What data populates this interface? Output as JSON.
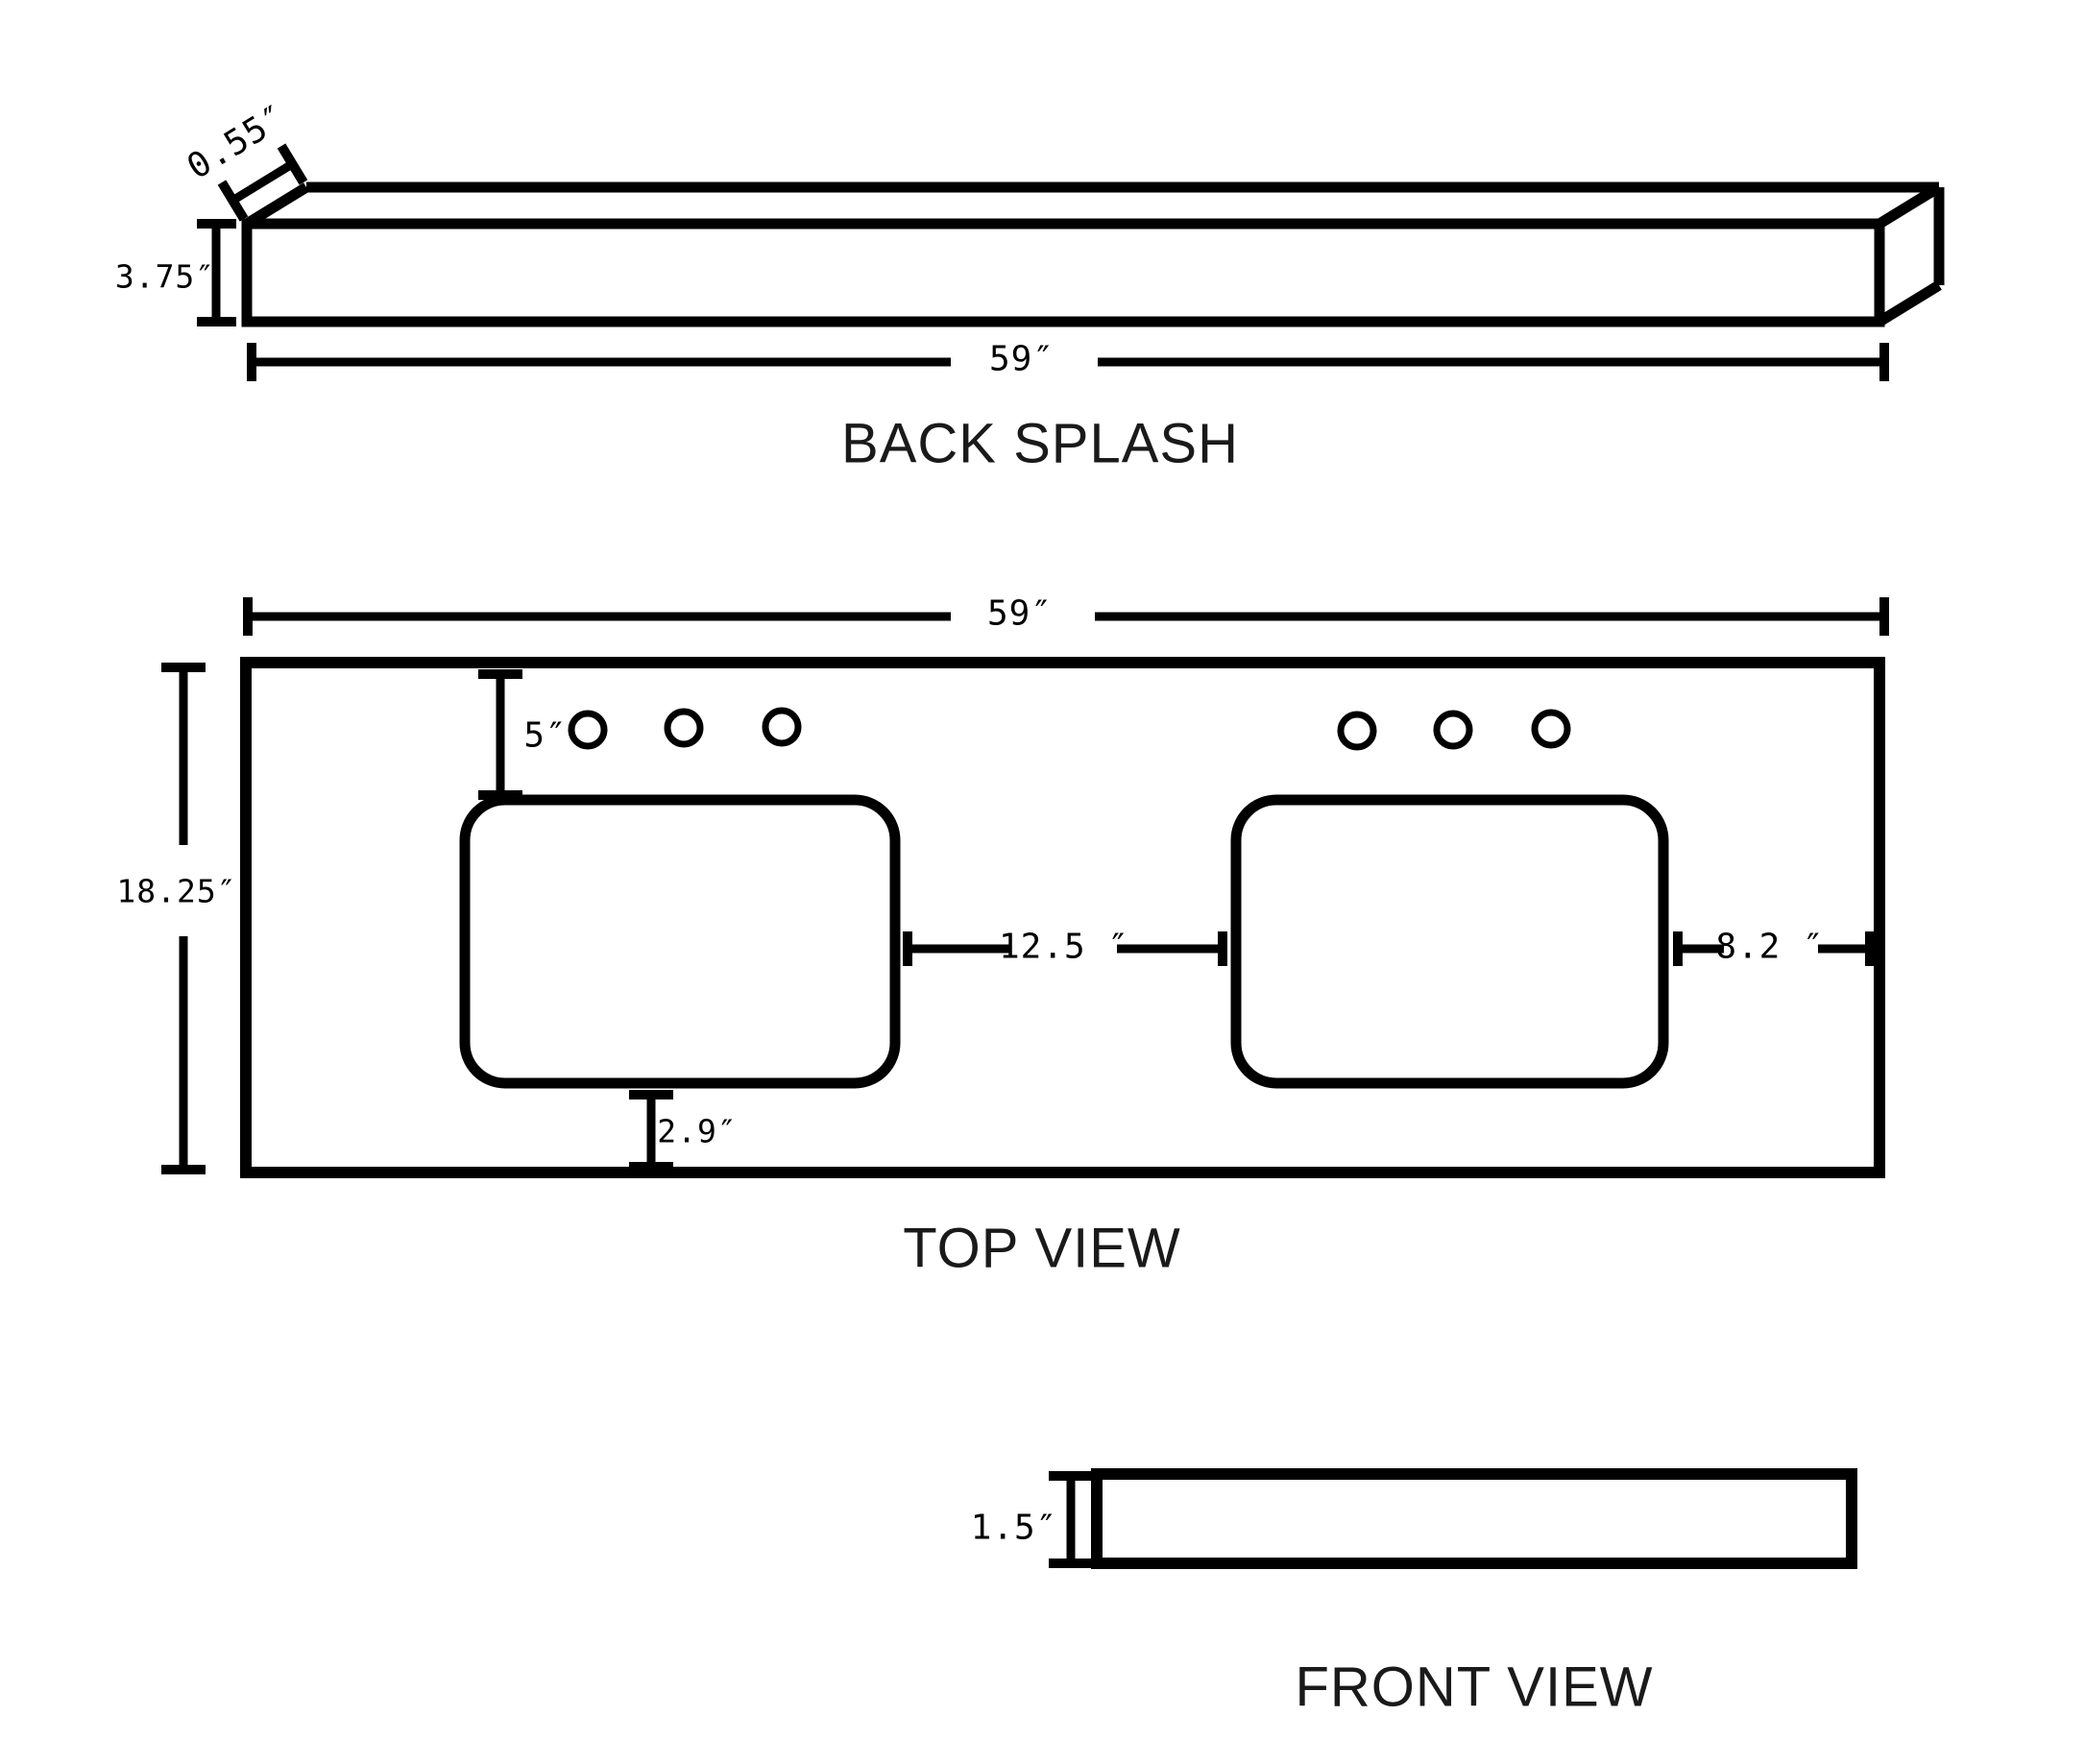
{
  "page": {
    "background": "#ffffff",
    "line_color": "#000000"
  },
  "back_splash": {
    "title": "BACK SPLASH",
    "dims": {
      "width": "59″",
      "height": "3.75″",
      "depth": "0.55″"
    }
  },
  "top_view": {
    "title": "TOP VIEW",
    "dims": {
      "width": "59″",
      "depth": "18.25″",
      "faucet_setback": "5″",
      "between_sinks": "12.5 ″",
      "sink_to_right_edge": "8.2 ″",
      "sink_to_front_edge": "2.9″"
    },
    "faucet_holes_per_sink": 3,
    "sink_count": 2
  },
  "front_view": {
    "title": "FRONT VIEW",
    "dims": {
      "height": "1.5″"
    }
  }
}
